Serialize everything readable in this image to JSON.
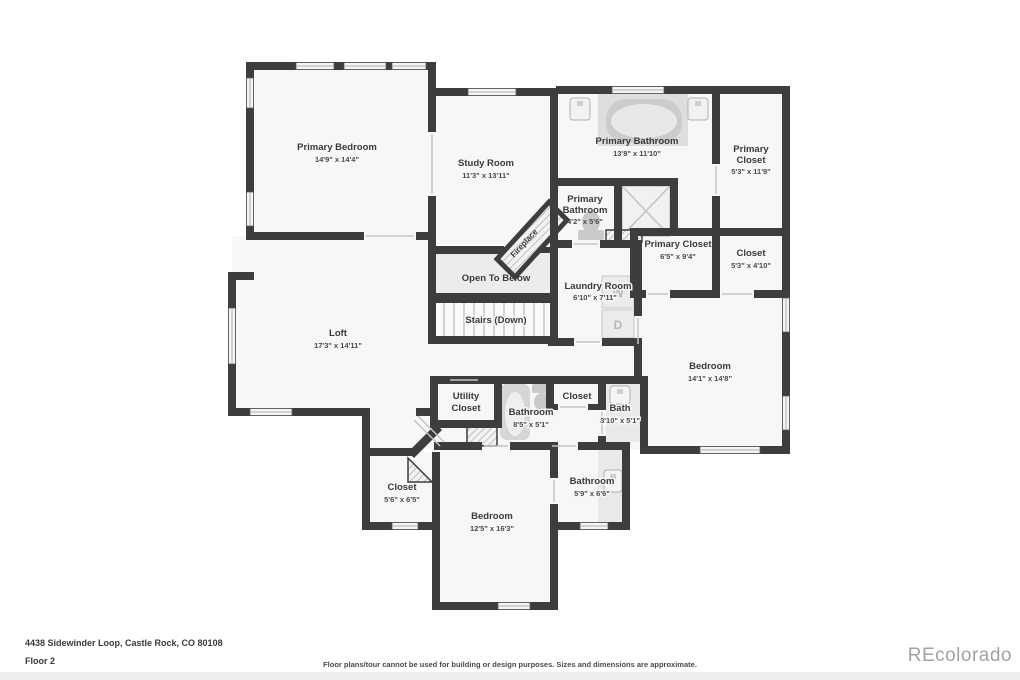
{
  "colors": {
    "wall": "#3d3d3d",
    "room_fill": "#f7f7f7",
    "open_area_fill": "#ececec",
    "fixture_fill": "#e9e9e9",
    "label_text": "#3a3a3a",
    "watermark_text": "#a2a2a2"
  },
  "rooms": {
    "primary_bedroom": {
      "name": "Primary Bedroom",
      "dims": "14'9\" x 14'4\""
    },
    "study_room": {
      "name": "Study Room",
      "dims": "11'3\" x 13'11\""
    },
    "primary_bathroom": {
      "name": "Primary Bathroom",
      "dims": "13'8\" x 11'10\""
    },
    "primary_closet_upper": {
      "line1": "Primary",
      "line2": "Closet",
      "dims": "5'3\" x 11'9\""
    },
    "primary_bathroom_small": {
      "line1": "Primary",
      "line2": "Bathroom",
      "dims": "4'2\" x 5'6\""
    },
    "fireplace": {
      "name": "Fireplace"
    },
    "primary_closet_mid": {
      "name": "Primary Closet",
      "dims": "6'5\" x 9'4\""
    },
    "closet_mid_right": {
      "name": "Closet",
      "dims": "5'3\" x 4'10\""
    },
    "open_to_below": {
      "name": "Open To Below"
    },
    "stairs": {
      "name": "Stairs (Down)"
    },
    "laundry": {
      "name": "Laundry Room",
      "dims": "6'10\" x 7'11\"",
      "washer": "W",
      "dryer": "D"
    },
    "loft": {
      "name": "Loft",
      "dims": "17'3\" x 14'11\""
    },
    "bedroom_right": {
      "name": "Bedroom",
      "dims": "14'1\" x 14'8\""
    },
    "utility_closet": {
      "line1": "Utility",
      "line2": "Closet"
    },
    "bathroom_mid": {
      "name": "Bathroom",
      "dims": "8'5\" x 5'1\""
    },
    "closet_hall": {
      "name": "Closet"
    },
    "bath": {
      "name": "Bath",
      "dims": "3'10\" x 5'1\""
    },
    "closet_lower": {
      "name": "Closet",
      "dims": "5'6\" x 6'5\""
    },
    "bedroom_lower": {
      "name": "Bedroom",
      "dims": "12'5\" x 16'3\""
    },
    "bathroom_lower": {
      "name": "Bathroom",
      "dims": "5'9\" x 6'6\""
    }
  },
  "footer": {
    "address": "4438 Sidewinder Loop, Castle Rock, CO 80108",
    "floor_label": "Floor 2",
    "disclaimer": "Floor plans/tour cannot be used for building or design purposes. Sizes and dimensions are approximate.",
    "watermark": "REcolorado"
  }
}
